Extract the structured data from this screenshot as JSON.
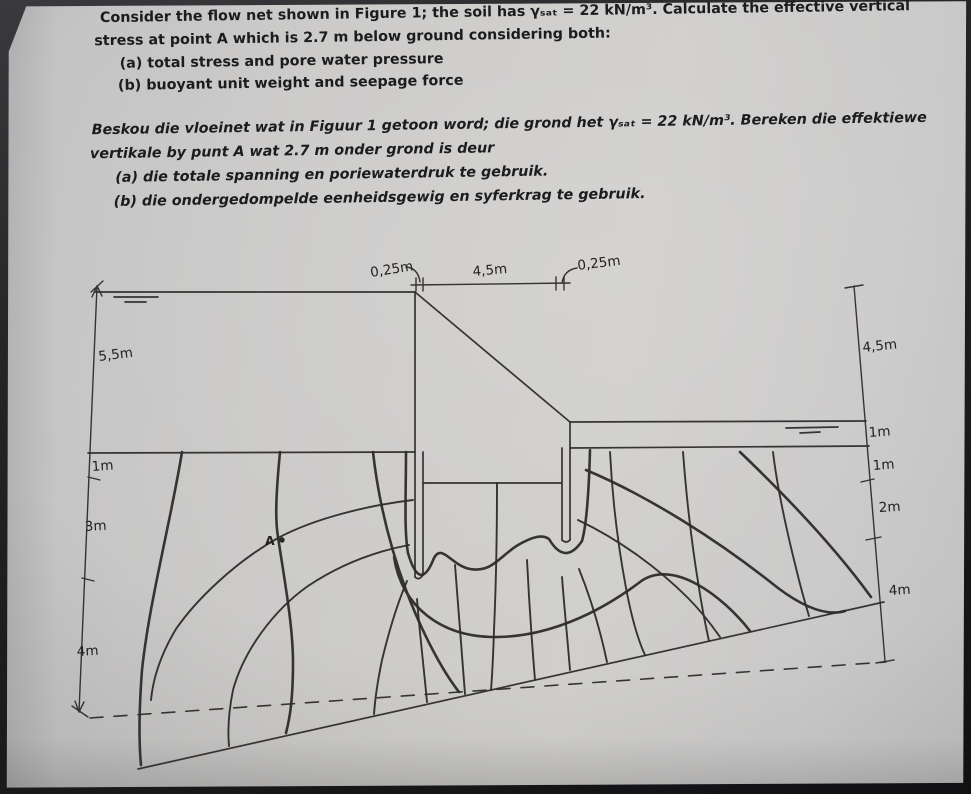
{
  "problem_en": {
    "intro_line1": "Consider the flow net shown in Figure 1; the soil has γₛₐₜ = 22 kN/m³. Calculate the effective vertical",
    "intro_line2": "stress at point A which is 2.7 m below ground considering both:",
    "item_a": "(a) total stress and pore water pressure",
    "item_b": "(b) buoyant unit weight and seepage force"
  },
  "problem_af": {
    "intro_line1": "Beskou die vloeinet wat in Figuur 1 getoon word; die grond het γₛₐₜ = 22 kN/m³. Bereken die effektiewe",
    "intro_line2": "vertikale by punt A wat 2.7 m onder grond is deur",
    "item_a": "(a) die totale spanning en poriewaterdruk te gebruik.",
    "item_b": "(b) die ondergedompelde eenheidsgewig en syferkrag te gebruik."
  },
  "figure": {
    "top_dims": {
      "left_offset": "0,25m",
      "span": "4,5m",
      "right_offset": "0,25m"
    },
    "left_dims": {
      "water_height": "5,5m",
      "d1": "1m",
      "d2": "3m",
      "d3": "4m"
    },
    "right_dims": {
      "water_height": "4,5m",
      "d1": "1m",
      "d2": "1m",
      "d3": "2m",
      "d4": "4m"
    },
    "point_label": "A"
  }
}
